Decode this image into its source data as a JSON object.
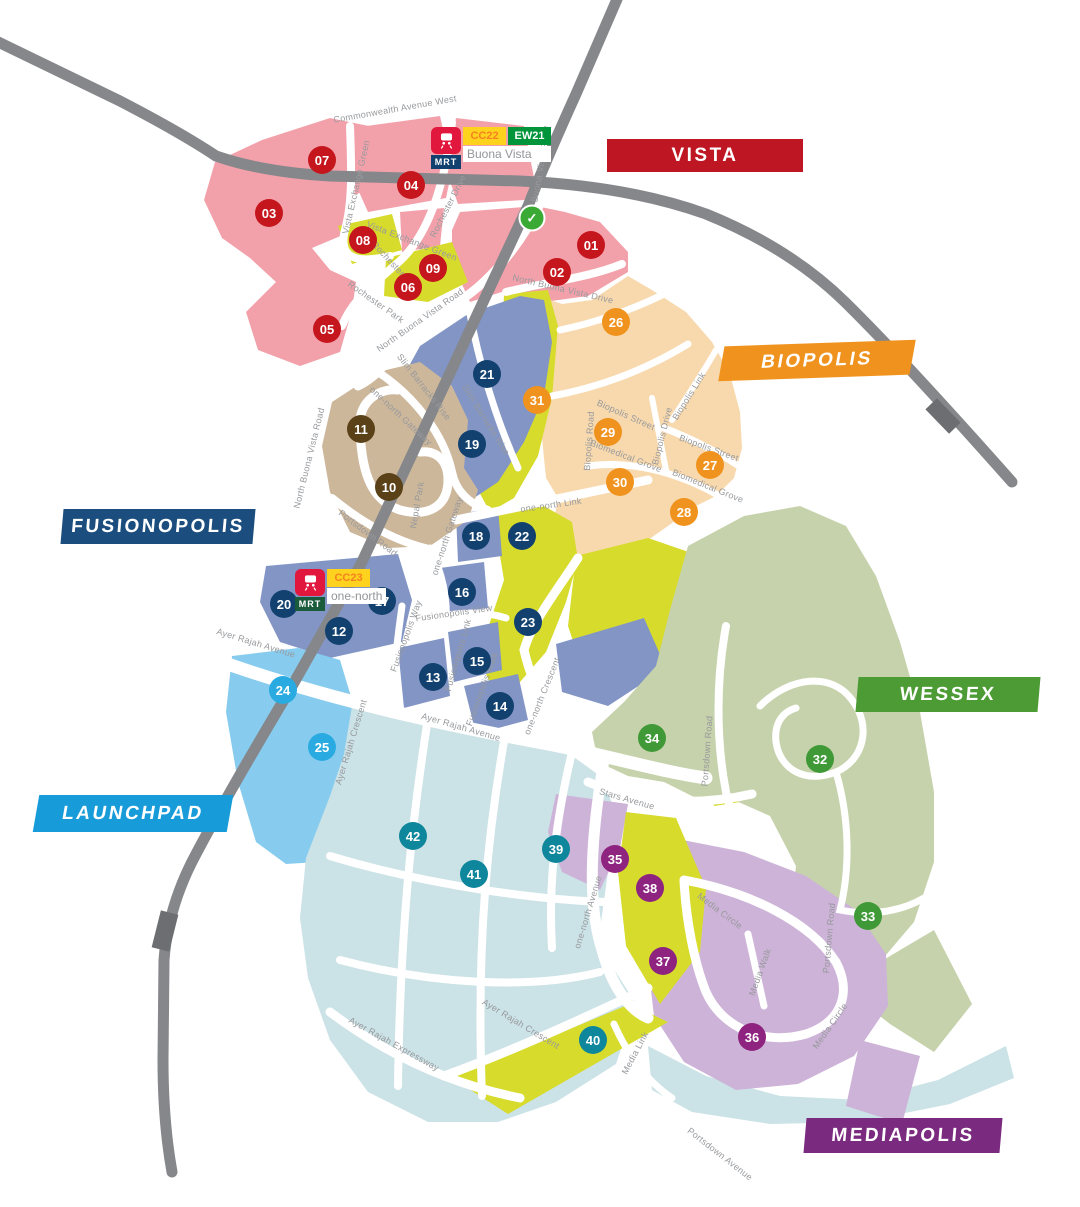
{
  "districts": [
    {
      "id": "vista",
      "label": "VISTA",
      "bg": "#BE1622",
      "x": 607,
      "y": 139,
      "w": 196,
      "h": 33
    },
    {
      "id": "biopolis",
      "label": "BIOPOLIS",
      "bg": "#F0931E",
      "x": 722,
      "y": 343,
      "w": 190,
      "h": 35
    },
    {
      "id": "fusionopolis",
      "label": "FUSIONOPOLIS",
      "bg": "#1B4E7E",
      "x": 62,
      "y": 509,
      "w": 192,
      "h": 35
    },
    {
      "id": "wessex",
      "label": "WESSEX",
      "bg": "#4D9B35",
      "x": 857,
      "y": 677,
      "w": 182,
      "h": 35
    },
    {
      "id": "launchpad",
      "label": "LAUNCHPAD",
      "bg": "#189CD9",
      "x": 36,
      "y": 795,
      "w": 194,
      "h": 37
    },
    {
      "id": "mediapolis",
      "label": "MEDIAPOLIS",
      "bg": "#7B2B7F",
      "x": 805,
      "y": 1118,
      "w": 196,
      "h": 35
    }
  ],
  "markers": [
    {
      "n": "01",
      "x": 591,
      "y": 245,
      "c": "#C4161C"
    },
    {
      "n": "02",
      "x": 557,
      "y": 272,
      "c": "#C4161C"
    },
    {
      "n": "03",
      "x": 269,
      "y": 213,
      "c": "#C4161C"
    },
    {
      "n": "04",
      "x": 411,
      "y": 185,
      "c": "#C4161C"
    },
    {
      "n": "05",
      "x": 327,
      "y": 329,
      "c": "#C4161C"
    },
    {
      "n": "06",
      "x": 408,
      "y": 287,
      "c": "#C4161C"
    },
    {
      "n": "07",
      "x": 322,
      "y": 160,
      "c": "#C4161C"
    },
    {
      "n": "08",
      "x": 363,
      "y": 240,
      "c": "#C4161C"
    },
    {
      "n": "09",
      "x": 433,
      "y": 268,
      "c": "#C4161C"
    },
    {
      "n": "10",
      "x": 389,
      "y": 487,
      "c": "#5A4118"
    },
    {
      "n": "11",
      "x": 361,
      "y": 429,
      "c": "#5A4118"
    },
    {
      "n": "12",
      "x": 339,
      "y": 631,
      "c": "#12416F"
    },
    {
      "n": "13",
      "x": 433,
      "y": 677,
      "c": "#12416F"
    },
    {
      "n": "14",
      "x": 500,
      "y": 706,
      "c": "#12416F"
    },
    {
      "n": "15",
      "x": 477,
      "y": 661,
      "c": "#12416F"
    },
    {
      "n": "16",
      "x": 462,
      "y": 592,
      "c": "#12416F"
    },
    {
      "n": "17",
      "x": 382,
      "y": 601,
      "c": "#12416F"
    },
    {
      "n": "18",
      "x": 476,
      "y": 536,
      "c": "#12416F"
    },
    {
      "n": "19",
      "x": 472,
      "y": 444,
      "c": "#12416F"
    },
    {
      "n": "20",
      "x": 284,
      "y": 604,
      "c": "#12416F"
    },
    {
      "n": "21",
      "x": 487,
      "y": 374,
      "c": "#12416F"
    },
    {
      "n": "22",
      "x": 522,
      "y": 536,
      "c": "#12416F"
    },
    {
      "n": "23",
      "x": 528,
      "y": 622,
      "c": "#12416F"
    },
    {
      "n": "24",
      "x": 283,
      "y": 690,
      "c": "#29ABE2"
    },
    {
      "n": "25",
      "x": 322,
      "y": 747,
      "c": "#29ABE2"
    },
    {
      "n": "26",
      "x": 616,
      "y": 322,
      "c": "#F0931E"
    },
    {
      "n": "27",
      "x": 710,
      "y": 465,
      "c": "#F0931E"
    },
    {
      "n": "28",
      "x": 684,
      "y": 512,
      "c": "#F0931E"
    },
    {
      "n": "29",
      "x": 608,
      "y": 432,
      "c": "#F0931E"
    },
    {
      "n": "30",
      "x": 620,
      "y": 482,
      "c": "#F0931E"
    },
    {
      "n": "31",
      "x": 537,
      "y": 400,
      "c": "#F0931E"
    },
    {
      "n": "32",
      "x": 820,
      "y": 759,
      "c": "#3E9936"
    },
    {
      "n": "33",
      "x": 868,
      "y": 916,
      "c": "#3E9936"
    },
    {
      "n": "34",
      "x": 652,
      "y": 738,
      "c": "#3E9936"
    },
    {
      "n": "35",
      "x": 615,
      "y": 859,
      "c": "#8E2480"
    },
    {
      "n": "36",
      "x": 752,
      "y": 1037,
      "c": "#8E2480"
    },
    {
      "n": "37",
      "x": 663,
      "y": 961,
      "c": "#8E2480"
    },
    {
      "n": "38",
      "x": 650,
      "y": 888,
      "c": "#8E2480"
    },
    {
      "n": "39",
      "x": 556,
      "y": 849,
      "c": "#0E869B"
    },
    {
      "n": "40",
      "x": 593,
      "y": 1040,
      "c": "#0E869B"
    },
    {
      "n": "41",
      "x": 474,
      "y": 874,
      "c": "#0E869B"
    },
    {
      "n": "42",
      "x": 413,
      "y": 836,
      "c": "#0E869B"
    }
  ],
  "road_labels": [
    {
      "t": "Commonwealth Avenue West",
      "x": 395,
      "y": 109,
      "a": -10
    },
    {
      "t": "Vista Exchange Green",
      "x": 356,
      "y": 187,
      "a": -77
    },
    {
      "t": "Rochester Drive",
      "x": 448,
      "y": 206,
      "a": -63
    },
    {
      "t": "Buona Vista Road",
      "x": 541,
      "y": 164,
      "a": -80
    },
    {
      "t": "Vista Exchange Green",
      "x": 412,
      "y": 241,
      "a": 21
    },
    {
      "t": "Rochester Drive",
      "x": 397,
      "y": 268,
      "a": 47
    },
    {
      "t": "Rochester Park",
      "x": 376,
      "y": 302,
      "a": 35
    },
    {
      "t": "North Buona Vista Road",
      "x": 420,
      "y": 320,
      "a": -35
    },
    {
      "t": "North Buona Vista Drive",
      "x": 563,
      "y": 289,
      "a": 13
    },
    {
      "t": "North Buona Vista Road",
      "x": 309,
      "y": 458,
      "a": -76
    },
    {
      "t": "one-north Gateway",
      "x": 401,
      "y": 416,
      "a": 43
    },
    {
      "t": "Slim Barracks Rise",
      "x": 424,
      "y": 387,
      "a": 52
    },
    {
      "t": "Slim Barracks Rise",
      "x": 486,
      "y": 420,
      "a": 58
    },
    {
      "t": "Nepal Park",
      "x": 417,
      "y": 505,
      "a": -80
    },
    {
      "t": "Portsdown Road",
      "x": 368,
      "y": 533,
      "a": 37
    },
    {
      "t": "one-north Gateway",
      "x": 447,
      "y": 536,
      "a": -72
    },
    {
      "t": "one-north Link",
      "x": 551,
      "y": 505,
      "a": -8
    },
    {
      "t": "Biopolis Street",
      "x": 626,
      "y": 415,
      "a": 24
    },
    {
      "t": "Biopolis Road",
      "x": 589,
      "y": 441,
      "a": -86
    },
    {
      "t": "Biopolis Drive",
      "x": 662,
      "y": 436,
      "a": -76
    },
    {
      "t": "Biopolis Link",
      "x": 689,
      "y": 396,
      "a": -58
    },
    {
      "t": "Biopolis Street",
      "x": 709,
      "y": 448,
      "a": 20
    },
    {
      "t": "Biomedical Grove",
      "x": 626,
      "y": 456,
      "a": 21
    },
    {
      "t": "Biomedical Grove",
      "x": 708,
      "y": 486,
      "a": 22
    },
    {
      "t": "one-north Crescent",
      "x": 542,
      "y": 696,
      "a": -68
    },
    {
      "t": "Portsdown Road",
      "x": 707,
      "y": 751,
      "a": -86
    },
    {
      "t": "Stars Avenue",
      "x": 627,
      "y": 799,
      "a": 16
    },
    {
      "t": "Fusionopolis Way",
      "x": 406,
      "y": 636,
      "a": -70
    },
    {
      "t": "Fusionopolis View",
      "x": 454,
      "y": 613,
      "a": -8
    },
    {
      "t": "Fusionopolis Link",
      "x": 458,
      "y": 655,
      "a": -74
    },
    {
      "t": "Fusionopolis Walk",
      "x": 482,
      "y": 689,
      "a": -70
    },
    {
      "t": "Ayer Rajah Avenue",
      "x": 256,
      "y": 643,
      "a": 17
    },
    {
      "t": "Ayer Rajah Avenue",
      "x": 461,
      "y": 727,
      "a": 16
    },
    {
      "t": "Ayer Rajah Crescent",
      "x": 351,
      "y": 742,
      "a": -73
    },
    {
      "t": "Ayer Rajah Crescent",
      "x": 521,
      "y": 1024,
      "a": 31
    },
    {
      "t": "Ayer Rajah Expressway",
      "x": 394,
      "y": 1044,
      "a": 29
    },
    {
      "t": "one-north Avenue",
      "x": 588,
      "y": 912,
      "a": -73
    },
    {
      "t": "Media Circle",
      "x": 720,
      "y": 911,
      "a": 37
    },
    {
      "t": "Media Walk",
      "x": 760,
      "y": 972,
      "a": -70
    },
    {
      "t": "Portsdown Road",
      "x": 829,
      "y": 938,
      "a": -85
    },
    {
      "t": "Media Circle",
      "x": 830,
      "y": 1026,
      "a": -55
    },
    {
      "t": "Media Link",
      "x": 635,
      "y": 1053,
      "a": -62
    },
    {
      "t": "Portsdown Avenue",
      "x": 720,
      "y": 1154,
      "a": 38
    }
  ],
  "stations": [
    {
      "name": "Buona Vista",
      "x": 431,
      "y": 127,
      "mrt_label": "MRT",
      "mrt_bg": "#12416F",
      "icon_bg": "#E2173D",
      "codes": [
        {
          "code": "CC22",
          "bg": "#FFD21E",
          "fg": "#F58220"
        },
        {
          "code": "EW21",
          "bg": "#00953B",
          "fg": "#FFFFFF"
        }
      ]
    },
    {
      "name": "one-north",
      "x": 295,
      "y": 569,
      "mrt_label": "MRT",
      "mrt_bg": "#1A5B3C",
      "icon_bg": "#E2173D",
      "codes": [
        {
          "code": "CC23",
          "bg": "#FFD21E",
          "fg": "#F58220"
        }
      ]
    }
  ],
  "icons": [
    {
      "name": "green-check-icon",
      "glyph": "✓",
      "x": 532,
      "y": 218,
      "bg": "#3AAA35"
    }
  ],
  "zone_colors": {
    "vista_pink": "#F2A1AB",
    "biopolis_peach": "#F8D9AE",
    "core_yellow": "#D7DB2C",
    "fusionopolis_slate": "#8295C5",
    "tan_park": "#CDB79B",
    "launchpad_blue": "#87CCEF",
    "wessex_sage": "#C6D2AB",
    "mediapolis_purple": "#CDB3D8",
    "business_teal": "#CBE2E6",
    "railway": "#85878A",
    "railway_tick": "#6D6E71",
    "road": "#FFFFFF"
  }
}
